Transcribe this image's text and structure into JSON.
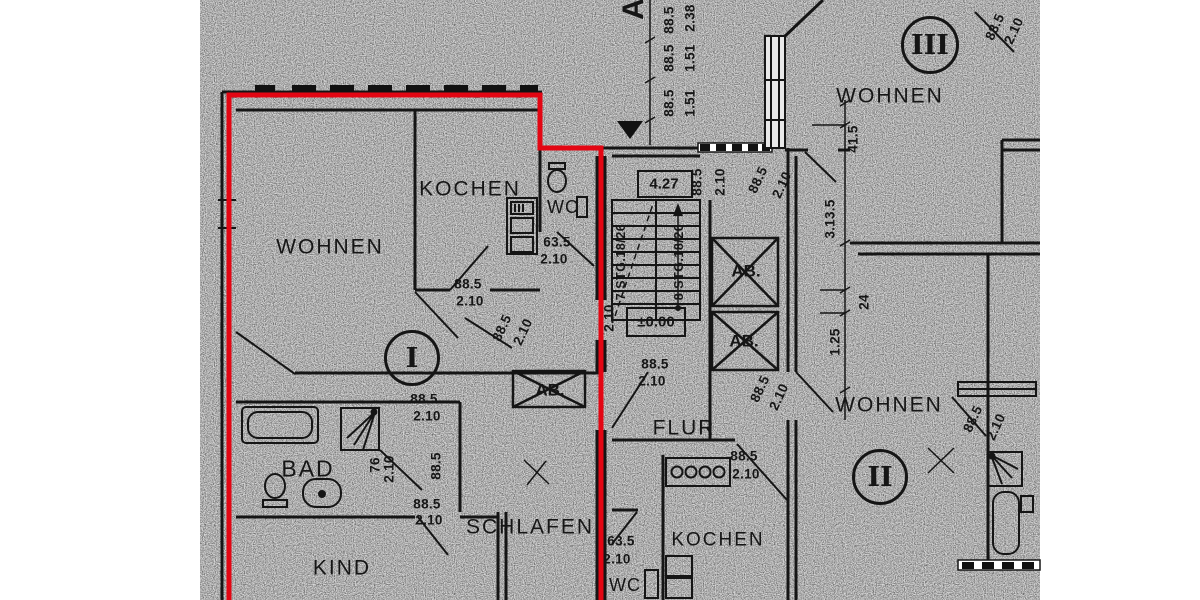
{
  "plan": {
    "highlight_color": "#e30613",
    "paper_color": "#d8d8d8",
    "ink_color": "#161616",
    "highlighted_unit": "I"
  },
  "rooms": {
    "wohnen1": "WOHNEN",
    "kochen1": "KOCHEN",
    "wc1": "WC",
    "bad": "BAD",
    "kind": "KIND",
    "schlafen": "SCHLAFEN",
    "flur": "FLUR",
    "kochen2": "KOCHEN",
    "wc2": "WC",
    "wohnen2": "WOHNEN",
    "wohnen3": "WOHNEN"
  },
  "units": {
    "i": "I",
    "ii": "II",
    "iii": "III"
  },
  "shafts": {
    "ab1": "AB.",
    "ab2": "AB.",
    "ab3": "AB."
  },
  "stairwell": {
    "flight_left": "7 STG.18/26",
    "flight_right": "8 STG.18/26",
    "level": "±0.00",
    "entry_width": "4.27",
    "section_marker": "A"
  },
  "icons": {
    "entrance_arrow": "triangle-down",
    "fixtures": [
      "bathtub",
      "shower",
      "toilet",
      "washbasin",
      "stove-burners",
      "kitchen-unit"
    ]
  },
  "dimensions": {
    "c1w": "88.5",
    "c1v": "2.38",
    "c2w": "88.5",
    "c2v": "1.51",
    "c3w": "88.5",
    "c3v": "1.51",
    "s1w": "88.5",
    "s1v": "2.10",
    "s2w": "88.5",
    "s2v": "2.10",
    "rtw": "88.5",
    "rtv": "2.10",
    "k1w": "88.5",
    "k1v": "2.10",
    "wc1w": "63.5",
    "wc1v": "2.10",
    "h1w": "88.5",
    "h1v": "2.10",
    "f1w": "88.5",
    "f1v": "2.10",
    "f2w": "88.5",
    "f2v": "2.10",
    "i1w": "88.5",
    "i1v": "2.10",
    "b1w": "76",
    "b1v": "2.10",
    "b2w": "88.5",
    "kdw": "88.5",
    "kdv": "2.10",
    "m1w": "88.5",
    "m1v": "2.10",
    "wc2w": "63.5",
    "wc2v": "2.10",
    "lone": "2.10",
    "rc1": "41.5",
    "rc2": "3.13.5",
    "rc3": "24",
    "rc4": "1.25",
    "brw": "88.5",
    "brv": "2.10"
  }
}
